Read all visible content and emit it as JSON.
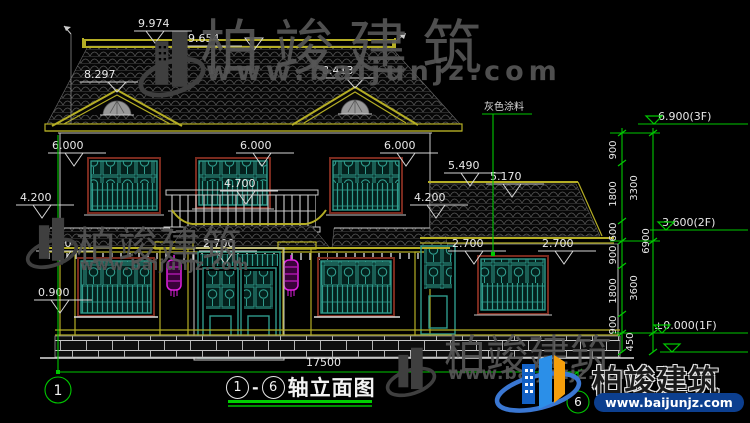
{
  "watermark": {
    "brand": "柏竣建筑",
    "url": "www.baijunjz.com"
  },
  "logo": {
    "brand": "柏竣建筑",
    "url": "www.baijunjz.com"
  },
  "note_gray_paint": "灰色涂料",
  "dims": {
    "ridge_a": "9.974",
    "ridge_b": "9.654",
    "gable_l": "8.297",
    "gable_r": "8.413",
    "eave_l": "6.000",
    "eave_c": "6.000",
    "eave_r": "6.000",
    "lvl42_l": "4.200",
    "lvl42_r": "4.200",
    "lvl47": "4.700",
    "wing_a": "5.490",
    "wing_b": "5.170",
    "lvl27_a": "2.700",
    "lvl27_b": "2.700",
    "lvl27_c": "2.700",
    "lvl27_d": "2.700",
    "sill": "0.900",
    "total_width": "17500"
  },
  "right_chain": {
    "segments": [
      "900",
      "1800",
      "600",
      "900",
      "1800",
      "900",
      "450"
    ],
    "groups": [
      "3300",
      "3600"
    ],
    "total": "6900",
    "level_3f": "6.900(3F)",
    "level_2f": "3.600(2F)",
    "level_1f": "±0.000(1F)"
  },
  "title_block": {
    "axis_left": "1",
    "separator": "-",
    "axis_right": "6",
    "label": "轴立面图"
  },
  "colors": {
    "axis_green": "#00c800",
    "roof_trim_yellow": "#b5ae25",
    "window_teal": "#2f9b8c",
    "frame_maroon": "#7a2a1e",
    "lantern_magenta": "#d916d9",
    "logo_blue": "#1b66c9",
    "logo_orange": "#f59e0b",
    "dim_white": "#e8e8e8"
  }
}
